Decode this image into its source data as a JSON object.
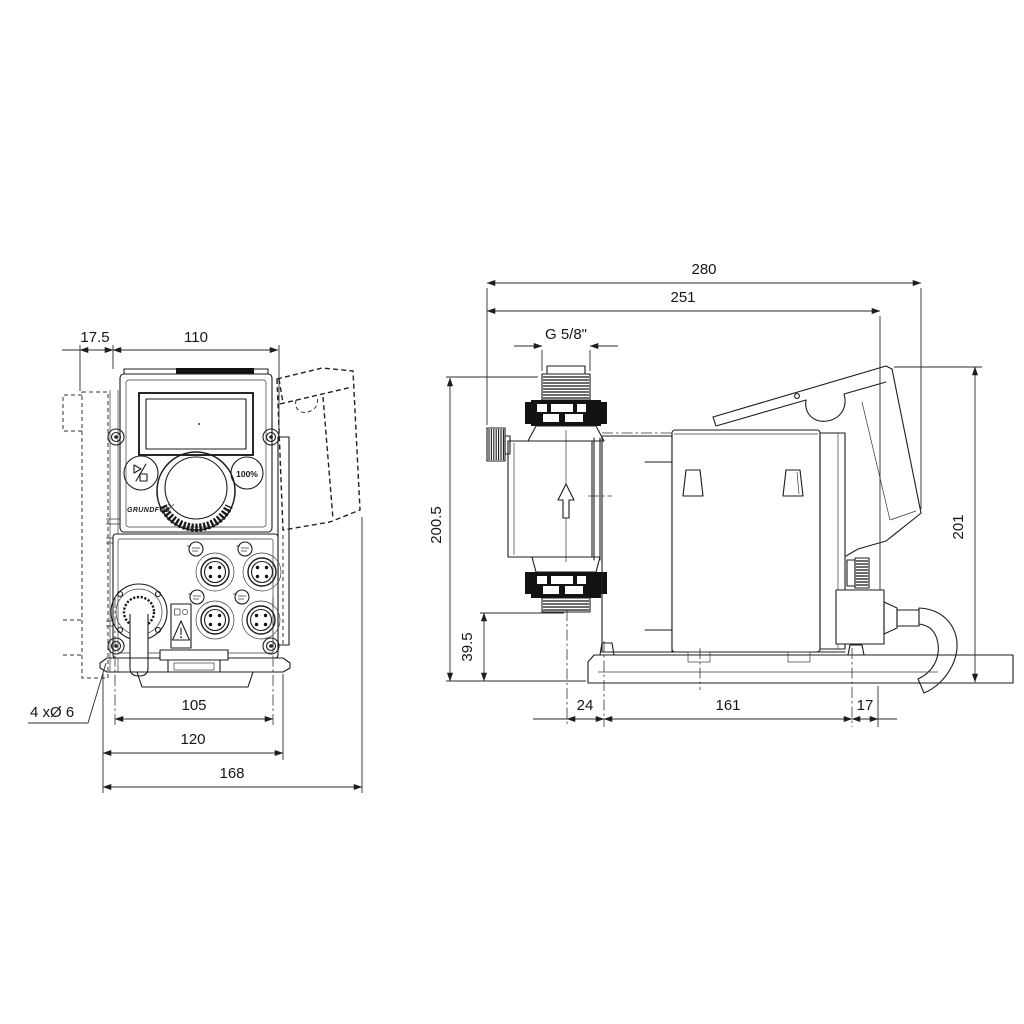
{
  "colors": {
    "line": "#1d1d1d",
    "dark_fill": "#121212",
    "background": "#ffffff"
  },
  "front_view": {
    "dims": {
      "offset": "17.5",
      "width": "110",
      "hole_pitch": "105",
      "plate_width": "120",
      "overall_width": "168",
      "holes": "4 xØ 6"
    },
    "panel": {
      "capacity_button": "100%",
      "brand": "GRUNDFOS"
    }
  },
  "side_view": {
    "dims": {
      "overall_depth": "280",
      "body_depth": "251",
      "thread": "G 5/8\"",
      "overall_height": "200.5",
      "valve_bottom_height": "39.5",
      "control_cube_height": "201",
      "foot_front_offset": "24",
      "foot_pitch": "161",
      "foot_rear_offset": "17"
    }
  }
}
